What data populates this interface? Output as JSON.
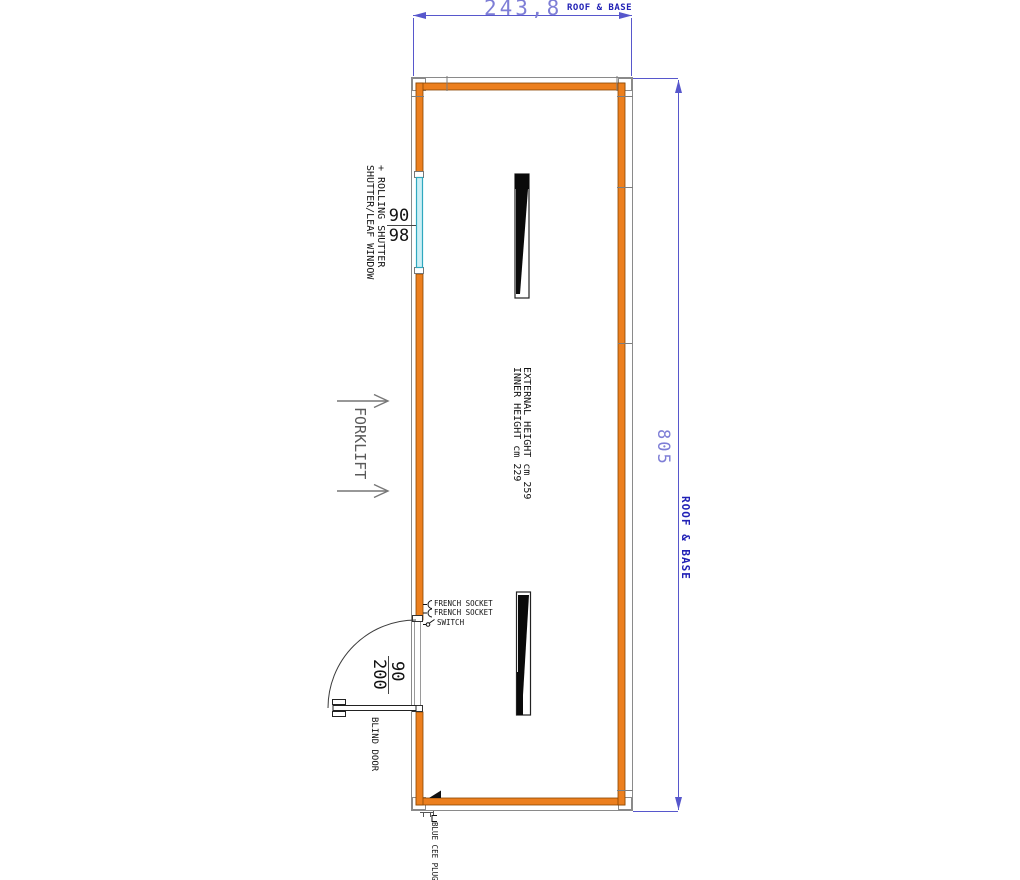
{
  "drawing_type": "container floor plan",
  "dimensions": {
    "top": {
      "value": "243,8",
      "suffix": "ROOF & BASE"
    },
    "right": {
      "value": "805",
      "suffix": "ROOF & BASE"
    }
  },
  "window": {
    "label_line1": "SHUTTER/LEAF WINDOW",
    "label_line2": "+ ROLLING SHUTTER",
    "width_cm": "90",
    "height_cm": "98"
  },
  "door": {
    "width_cm": "90",
    "height_cm": "200",
    "label": "BLIND DOOR"
  },
  "annotations": {
    "forklift": "FORKLIFT",
    "inner_height": "INNER HEIGHT cm 229",
    "external_height": "EXTERNAL HEIGHT cm 259"
  },
  "electrical": {
    "socket_1": "FRENCH SOCKET",
    "socket_2": "FRENCH SOCKET",
    "switch": "SWITCH",
    "cee_plug": "BLUE CEE PLUG"
  },
  "colors": {
    "wall_orange": "#ec7f1e",
    "wall_edge": "#8a4500",
    "frame_gray": "#8a8a8a",
    "dimension_line_blue": "#5757cc",
    "dim_value_periwinkle": "#7e7ed6",
    "dim_suffix_blue": "#2121b6",
    "window_glass_cyan": "#cdeff6",
    "window_frame_teal": "#2fa8bf",
    "forklift_gray": "#6e6e6e",
    "detail_black": "#111111"
  }
}
